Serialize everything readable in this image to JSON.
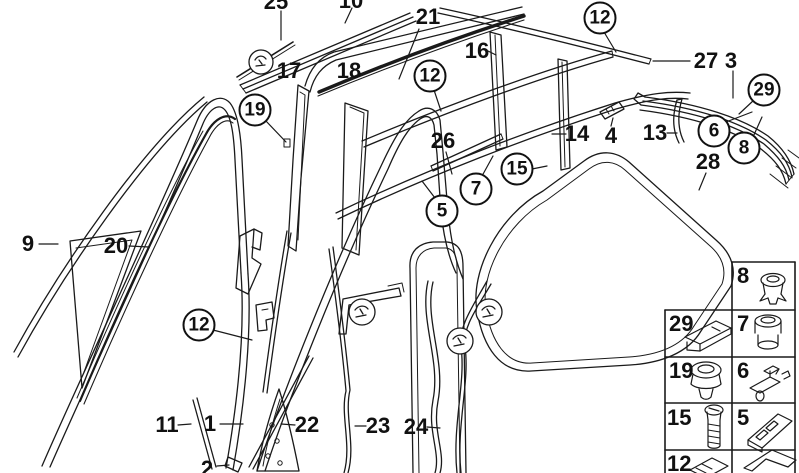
{
  "colors": {
    "line": "#1a1a1a",
    "background": "#ffffff"
  },
  "callouts": {
    "plain": {
      "n1": "1",
      "n2": "2",
      "n3": "3",
      "n4": "4",
      "n9": "9",
      "n10": "10",
      "n11": "11",
      "n13": "13",
      "n14": "14",
      "n16": "16",
      "n17": "17",
      "n18": "18",
      "n20": "20",
      "n21": "21",
      "n22": "22",
      "n23": "23",
      "n24": "24",
      "n25": "25",
      "n26": "26",
      "n27": "27",
      "n28": "28"
    },
    "circled": {
      "c5": "5",
      "c6": "6",
      "c7": "7",
      "c8": "8",
      "c12": "12",
      "c15": "15",
      "c19": "19",
      "c29": "29"
    }
  },
  "legend": {
    "cells": [
      {
        "num": "8",
        "icon": "grommet-icon"
      },
      {
        "num": "29",
        "icon": "clip-plate-icon"
      },
      {
        "num": "7",
        "icon": "sleeve-grommet-icon"
      },
      {
        "num": "19",
        "icon": "nut-grommet-icon"
      },
      {
        "num": "6",
        "icon": "retainer-clip-icon"
      },
      {
        "num": "15",
        "icon": "screw-bolt-icon"
      },
      {
        "num": "5",
        "icon": "angled-bracket-icon"
      },
      {
        "num": "12",
        "icon": "clip-plate-small-icon"
      },
      {
        "num": "",
        "icon": "arrow-chevron-icon"
      }
    ]
  }
}
